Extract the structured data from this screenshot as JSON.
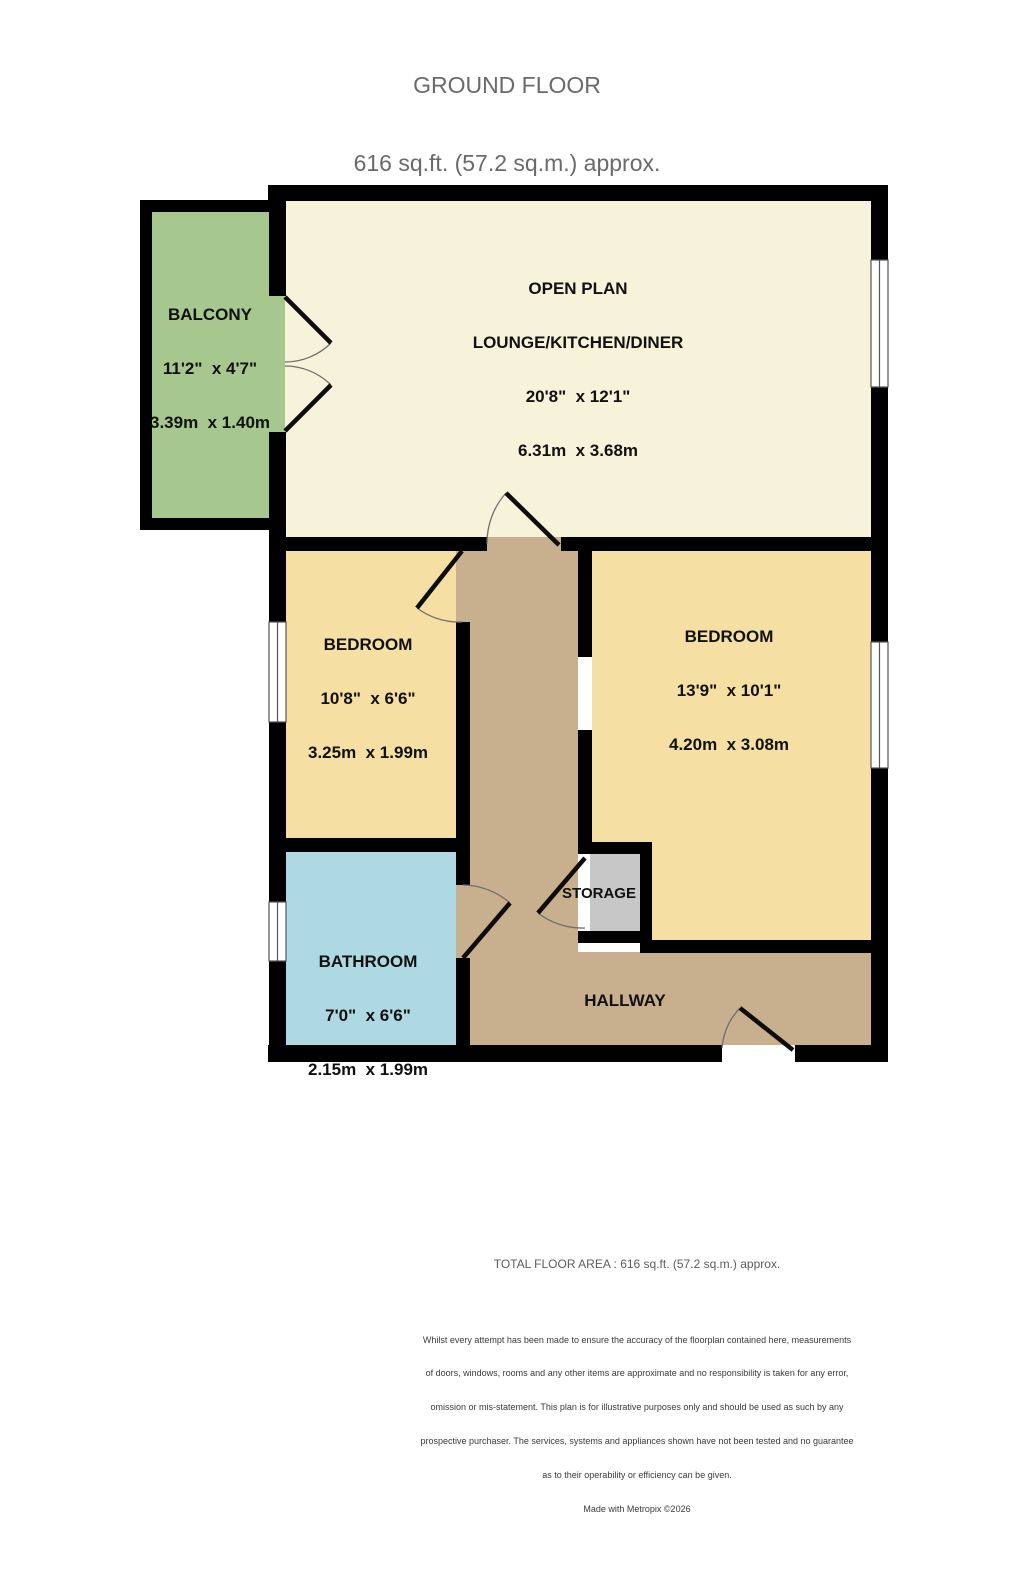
{
  "title": {
    "line1": "GROUND FLOOR",
    "line2": "616 sq.ft. (57.2 sq.m.) approx."
  },
  "rooms": {
    "balcony": {
      "name": "BALCONY",
      "imperial": "11'2\"  x 4'7\"",
      "metric": "3.39m  x 1.40m"
    },
    "lounge": {
      "name_line1": "OPEN PLAN",
      "name_line2": "LOUNGE/KITCHEN/DINER",
      "imperial": "20'8\"  x 12'1\"",
      "metric": "6.31m  x 3.68m"
    },
    "bedroom_left": {
      "name": "BEDROOM",
      "imperial": "10'8\"  x 6'6\"",
      "metric": "3.25m  x 1.99m"
    },
    "bedroom_right": {
      "name": "BEDROOM",
      "imperial": "13'9\"  x 10'1\"",
      "metric": "4.20m  x 3.08m"
    },
    "bathroom": {
      "name": "BATHROOM",
      "imperial": "7'0\"  x 6'6\"",
      "metric": "2.15m  x 1.99m"
    },
    "storage": {
      "name": "STORAGE"
    },
    "hallway": {
      "name": "HALLWAY"
    }
  },
  "footer": {
    "total": "TOTAL FLOOR AREA : 616 sq.ft. (57.2 sq.m.) approx.",
    "disclaimer_lines": [
      "Whilst every attempt has been made to ensure the accuracy of the floorplan contained here, measurements",
      "of doors, windows, rooms and any other items are approximate and no responsibility is taken for any error,",
      "omission or mis-statement. This plan is for illustrative purposes only and should be used as such by any",
      "prospective purchaser. The services, systems and appliances shown have not been tested and no guarantee",
      "as to their operability or efficiency can be given."
    ],
    "made_with": "Made with Metropix ©2026"
  },
  "colors": {
    "wall": "#000000",
    "lounge": "#f7f3da",
    "bedroom": "#f5dfa2",
    "bathroom": "#aed8e2",
    "hallway": "#c8af8d",
    "balcony": "#a6c88e",
    "storage": "#c7c7c7",
    "window_fill": "#ffffff",
    "window_frame": "#555555",
    "door_leaf": "#0d0d0d",
    "door_arc": "#6f6f6f"
  }
}
